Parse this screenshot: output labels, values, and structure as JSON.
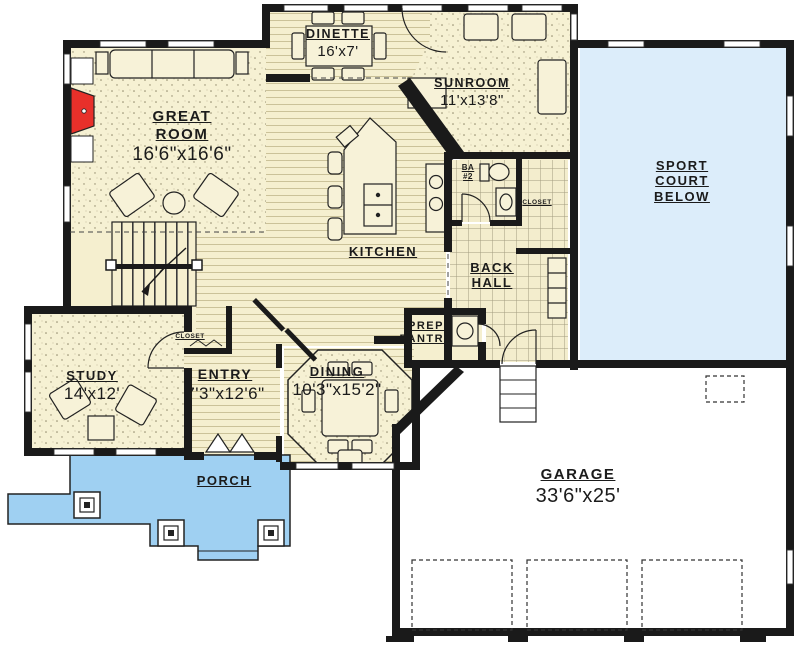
{
  "colors": {
    "wall": "#1A1A1A",
    "floor_cream": "#F6F1D3",
    "porch_blue": "#9FD0F2",
    "sport_court_blue": "#DCEDFA",
    "garage_white": "#FFFFFF",
    "fireplace_red": "#E8302A",
    "label_ink": "#1B1B1B"
  },
  "rooms": {
    "great_room": {
      "name": "GREAT\nROOM",
      "dims": "16'6\"x16'6\""
    },
    "dinette": {
      "name": "DINETTE",
      "dims": "16'x7'"
    },
    "sunroom": {
      "name": "SUNROOM",
      "dims": "11'x13'8\""
    },
    "sport_court": {
      "name": "SPORT\nCOURT\nBELOW"
    },
    "kitchen": {
      "name": "KITCHEN"
    },
    "back_hall": {
      "name": "BACK\nHALL"
    },
    "prep_pantry": {
      "name": "PREP\nPANTRY"
    },
    "bath_2": {
      "name": "BA\n#2"
    },
    "closet_hall": {
      "name": "CLOSET"
    },
    "closet_entry": {
      "name": "CLOSET"
    },
    "study": {
      "name": "STUDY",
      "dims": "14'x12'"
    },
    "entry": {
      "name": "ENTRY",
      "dims": "7'3\"x12'6\""
    },
    "dining": {
      "name": "DINING",
      "dims": "10'3\"x15'2\""
    },
    "porch": {
      "name": "PORCH"
    },
    "garage": {
      "name": "GARAGE",
      "dims": "33'6\"x25'"
    }
  }
}
